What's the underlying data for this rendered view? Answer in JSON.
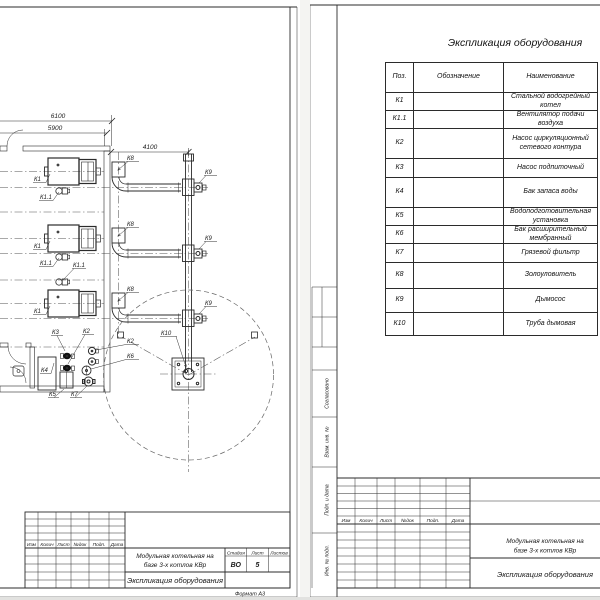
{
  "left_sheet": {
    "drawing": {
      "dim_width_outer": "6100",
      "dim_width_inner": "5900",
      "dim_flue": "4100",
      "labels": {
        "boiler": "К1",
        "fan": "К1.1",
        "ash_catcher": "К8",
        "smoke_exhauster": "К9",
        "chimney": "К10",
        "storage_tank": "К4",
        "water_treatment": "К5",
        "makeup_pump": "К3",
        "circ_pump": "К2",
        "expansion_tank": "К6",
        "mud_filter": "К7"
      }
    },
    "title_block": {
      "rev_cols": [
        "Изм",
        "Колич",
        "Лист",
        "№док",
        "Подп.",
        "Дата"
      ],
      "project_title_lines": [
        "Модульная котельная на",
        "базе 3-х котлов КВр"
      ],
      "doc_title": "Экспликация оборудования",
      "stage_label": "Стадия",
      "sheet_label": "Лист",
      "sheets_label": "Листов",
      "stage_value": "ВО",
      "sheet_value": "5",
      "sheets_value": "",
      "format_note": "Формат А3"
    }
  },
  "right_sheet": {
    "spec_title": "Экспликация оборудования",
    "table": {
      "col_pos": "Поз.",
      "col_designation": "Обозначение",
      "col_name": "Наименование",
      "rows": [
        {
          "pos": "К1",
          "designation": "",
          "name": "Стальной водогрейный котел"
        },
        {
          "pos": "К1.1",
          "designation": "",
          "name": "Вентилятор подачи воздуха"
        },
        {
          "pos": "К2",
          "designation": "",
          "name": "Насос циркуляционный сетевого контура"
        },
        {
          "pos": "К3",
          "designation": "",
          "name": "Насос подпиточный"
        },
        {
          "pos": "К4",
          "designation": "",
          "name": "Бак запаса воды"
        },
        {
          "pos": "К5",
          "designation": "",
          "name": "Водоподготовительная установка"
        },
        {
          "pos": "К6",
          "designation": "",
          "name": "Бак расширительный мембранный"
        },
        {
          "pos": "К7",
          "designation": "",
          "name": "Грязевой фильтр"
        },
        {
          "pos": "К8",
          "designation": "",
          "name": "Золоуловитель"
        },
        {
          "pos": "К9",
          "designation": "",
          "name": "Дымосос"
        },
        {
          "pos": "К10",
          "designation": "",
          "name": "Труба дымовая"
        }
      ]
    },
    "side_stamp": {
      "agreed": "Согласовано",
      "replace_inv": "Взам. инв. №",
      "sign_date": "Подп. и дата",
      "inv_orig": "Инв. № подл."
    },
    "title_block": {
      "rev_cols": [
        "Изм",
        "Колич",
        "Лист",
        "№док",
        "Подп.",
        "Дата"
      ],
      "project_title_lines": [
        "Модульная котельная на",
        "базе 3-х котлов КВр"
      ],
      "doc_title": "Экспликация оборудования"
    }
  }
}
